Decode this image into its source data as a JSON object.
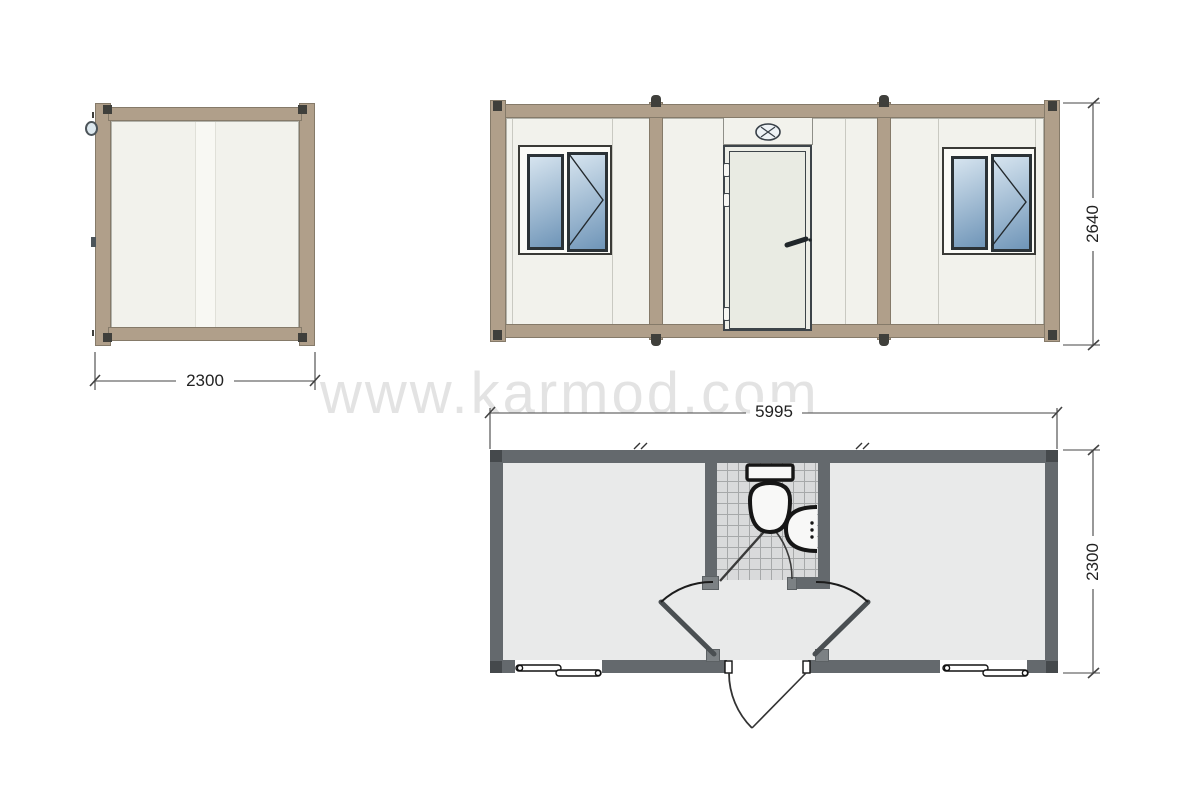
{
  "watermark": {
    "text": "www.karmod.com"
  },
  "dimensions": {
    "side_width": "2300",
    "front_width": "5995",
    "front_height": "2640",
    "plan_depth": "2300"
  },
  "colors": {
    "frame_tan": "#b09f8a",
    "panel_white": "#f2f2ec",
    "glass_light": "#d6e4ef",
    "glass_dark": "#6f95b8",
    "wall_gray": "#64696d",
    "floor_gray": "#e9eaea",
    "tile_gray": "#d9dadb",
    "watermark_gray": "#e3e3e3"
  }
}
